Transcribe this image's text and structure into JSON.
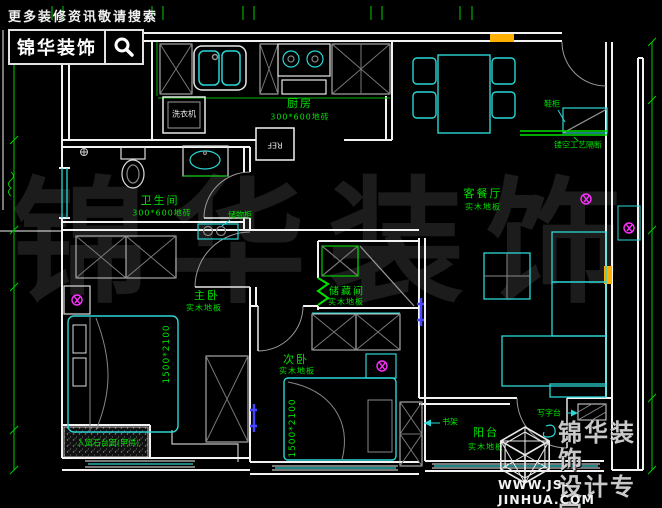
{
  "header": {
    "tagline": "更多装修资讯敬请搜索",
    "brand": "锦华装饰"
  },
  "watermark": "锦华装饰",
  "rooms": {
    "kitchen": {
      "name": "厨房",
      "material": "300*600地砖"
    },
    "bathroom": {
      "name": "卫生间",
      "material": "300*600地砖"
    },
    "living_dining": {
      "name": "客餐厅",
      "material": "实木地板"
    },
    "master_bedroom": {
      "name": "主卧",
      "material": "实木地板"
    },
    "second_bedroom": {
      "name": "次卧",
      "material": "实木地板"
    },
    "storage_room": {
      "name": "储藏间",
      "material": "实木地板"
    },
    "balcony": {
      "name": "阳台",
      "material": "实木地板"
    }
  },
  "labels": {
    "washing_machine": "洗衣机",
    "fridge": "REF",
    "storage_cabinet": "储物柜",
    "shoe_cabinet": "鞋柜",
    "partition": "镂空工艺隔断",
    "bookshelf": "书架",
    "desk": "写字台",
    "stone_countertop": "人造石台面(甲供)",
    "master_bed_size": "1500*2100",
    "second_bed_size": "1500*2100"
  },
  "footer": {
    "brand": "锦华装饰",
    "subtitle": "设计专家",
    "website": "WWW.JS-JINHUA.COM"
  },
  "colors": {
    "background": "#000000",
    "wall": "#f2f2f2",
    "furniture_cyan": "#2bd6d6",
    "annotation_green": "#00e000",
    "socket_magenta": "#ff30ff",
    "window_orange": "#ffb000",
    "tv_blue": "#4545ff",
    "watermark_gray": "#1c1c1c"
  }
}
